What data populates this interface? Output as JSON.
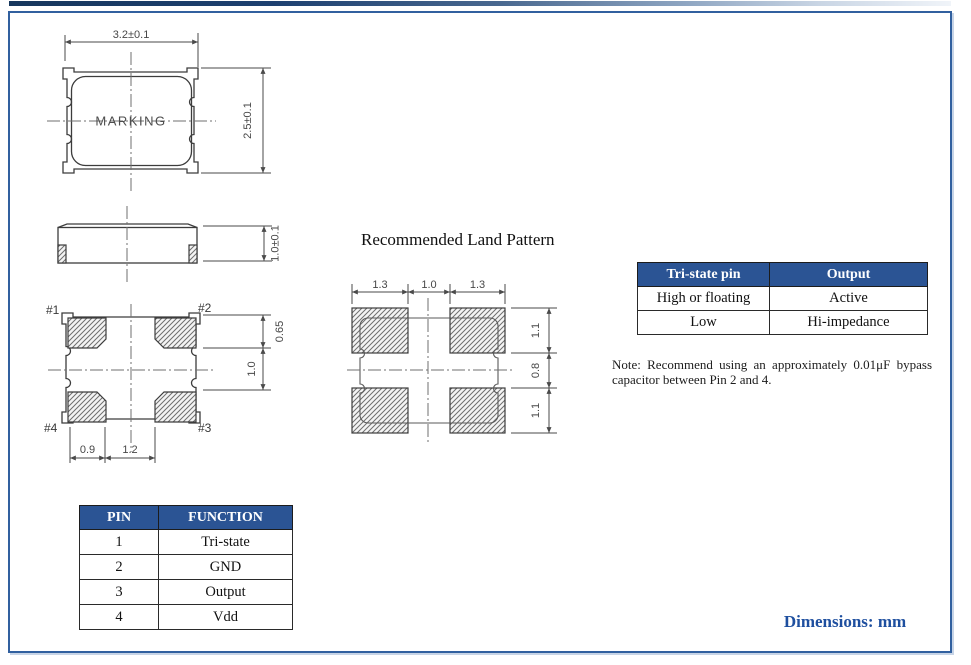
{
  "page": {
    "footer_note": "Dimensions: mm"
  },
  "package": {
    "top_view": {
      "width_dim": "3.2±0.1",
      "height_dim": "2.5±0.1",
      "marking": "MARKING"
    },
    "side_view": {
      "thickness_dim": "1.0±0.1"
    },
    "bottom_view": {
      "pin_labels": [
        "#1",
        "#2",
        "#3",
        "#4"
      ],
      "dim_pad_height": "0.65",
      "dim_pad_vgap": "1.0",
      "dim_pad_width": "0.9",
      "dim_pad_hgap": "1.2"
    }
  },
  "land_pattern": {
    "title": "Recommended Land Pattern",
    "dims_top": [
      "1.3",
      "1.0",
      "1.3"
    ],
    "dims_right": [
      "1.1",
      "0.8",
      "1.1"
    ]
  },
  "tristate_table": {
    "headers": [
      "Tri-state pin",
      "Output"
    ],
    "rows": [
      [
        "High or floating",
        "Active"
      ],
      [
        "Low",
        "Hi-impedance"
      ]
    ]
  },
  "note_text": "Note: Recommend using an approximately 0.01μF bypass capacitor between Pin 2 and 4.",
  "pin_table": {
    "headers": [
      "PIN",
      "FUNCTION"
    ],
    "rows": [
      [
        "1",
        "Tri-state"
      ],
      [
        "2",
        "GND"
      ],
      [
        "3",
        "Output"
      ],
      [
        "4",
        "Vdd"
      ]
    ]
  },
  "colors": {
    "table_header_bg": "#2b5494",
    "accent_blue": "#1e4f9f",
    "frame_border": "#31609f",
    "title_bar_navy": "#17375d"
  }
}
